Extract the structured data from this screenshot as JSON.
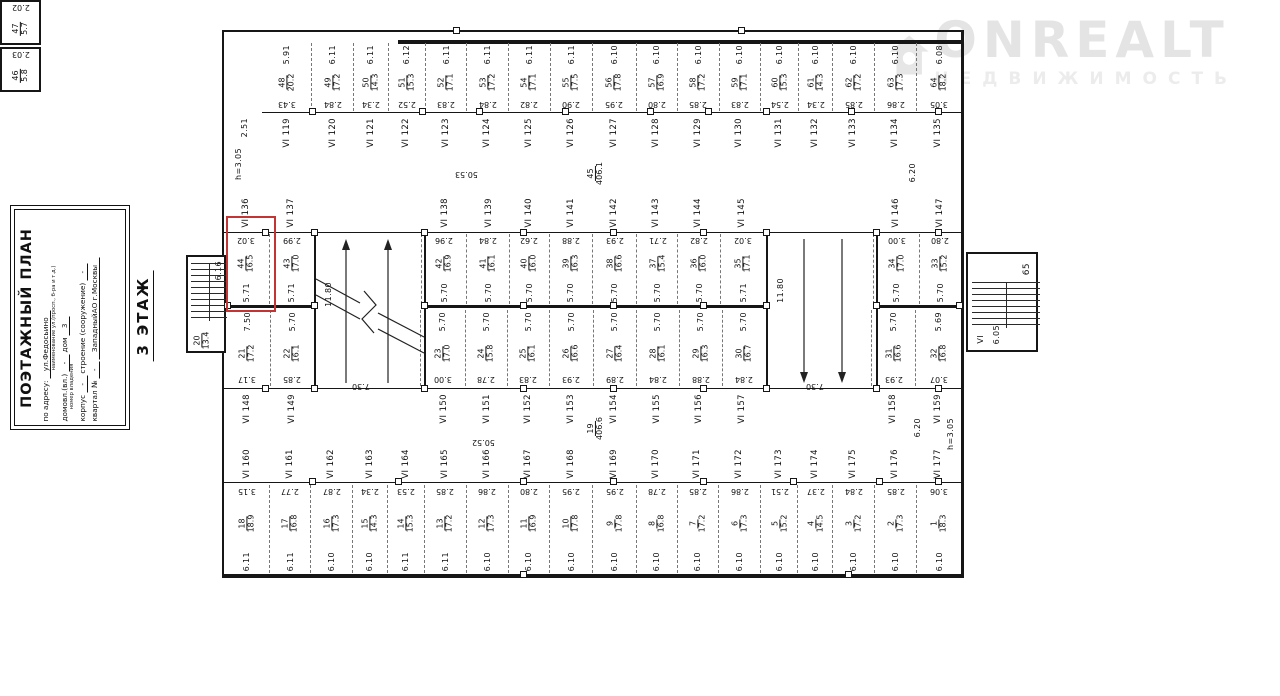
{
  "watermark": {
    "brand": "ONREALT",
    "subtitle": "НЕДВИЖИМОСТЬ"
  },
  "title_block": {
    "title": "ПОЭТАЖНЫЙ ПЛАН",
    "address_label": "по адресу:",
    "address_value": "ул.Федосьино",
    "address_caption": "наименование ул.(просп., б-ра и т.д.)",
    "ownership_label": "домовл.(вл.)",
    "ownership_value": "-",
    "ownership_caption": "номер владения",
    "house_label": "дом",
    "house_value": "3",
    "building_label": "корпус",
    "building_value": "-",
    "structure_label": "строение (сооружение)",
    "structure_value": "-",
    "block_label": "квартал №",
    "block_value": "-",
    "district_value": "ЗападныйАО г.Москвы"
  },
  "floor_label": "3 ЭТАЖ",
  "plan": {
    "left_dims": {
      "wall": "2.51",
      "note": "h=3.05"
    },
    "corner_rooms": [
      {
        "n": "47",
        "a": "5.7",
        "h": "2.02"
      },
      {
        "n": "46",
        "a": "5.8",
        "h": "2.03"
      }
    ],
    "top_units": [
      {
        "n": "48",
        "a": "20.2",
        "d": "5.91",
        "w": "3.43"
      },
      {
        "n": "49",
        "a": "17.2",
        "d": "6.11",
        "w": "2.84"
      },
      {
        "n": "50",
        "a": "14.3",
        "d": "6.11",
        "w": "2.34"
      },
      {
        "n": "51",
        "a": "15.3",
        "d": "6.12",
        "w": "2.52"
      },
      {
        "n": "52",
        "a": "17.1",
        "d": "6.11",
        "w": "2.83"
      },
      {
        "n": "53",
        "a": "17.2",
        "d": "6.11",
        "w": "2.84"
      },
      {
        "n": "54",
        "a": "17.1",
        "d": "6.11",
        "w": "2.82"
      },
      {
        "n": "55",
        "a": "17.5",
        "d": "6.11",
        "w": "2.90"
      },
      {
        "n": "56",
        "a": "17.8",
        "d": "6.10",
        "w": "2.95"
      },
      {
        "n": "57",
        "a": "16.9",
        "d": "6.10",
        "w": "2.80"
      },
      {
        "n": "58",
        "a": "17.2",
        "d": "6.10",
        "w": "2.85"
      },
      {
        "n": "59",
        "a": "17.1",
        "d": "6.10",
        "w": "2.83"
      },
      {
        "n": "60",
        "a": "15.3",
        "d": "6.10",
        "w": "2.54"
      },
      {
        "n": "61",
        "a": "14.3",
        "d": "6.10",
        "w": "2.34"
      },
      {
        "n": "62",
        "a": "17.2",
        "d": "6.10",
        "w": "2.85"
      },
      {
        "n": "63",
        "a": "17.3",
        "d": "6.10",
        "w": "2.86"
      },
      {
        "n": "64",
        "a": "18.2",
        "d": "6.08",
        "w": "3.05"
      }
    ],
    "vi_top": [
      "VI 119",
      "VI 120",
      "VI 121",
      "VI 122",
      "VI 123",
      "VI 124",
      "VI 125",
      "VI 126",
      "VI 127",
      "VI 128",
      "VI 129",
      "VI 130",
      "VI 131",
      "VI 132",
      "VI 133",
      "VI 134",
      "VI 135"
    ],
    "corridor_top": {
      "room": "45",
      "area": "406.1",
      "len": "50.53",
      "right_dim": "6.20"
    },
    "vi_upper": [
      "VI 136",
      "VI 137",
      "VI 138",
      "VI 139",
      "VI 140",
      "VI 141",
      "VI 142",
      "VI 143",
      "VI 144",
      "VI 145",
      "VI 146",
      "VI 147"
    ],
    "upper_mid_units": [
      {
        "n": "44",
        "a": "16.5",
        "w": "3.02",
        "d": "5.71"
      },
      {
        "n": "43",
        "a": "17.0",
        "w": "2.99",
        "d": "5.71"
      },
      {
        "ramp": "left",
        "w": "7.30"
      },
      {
        "n": "42",
        "a": "16.9",
        "w": "2.96",
        "d": "5.70"
      },
      {
        "n": "41",
        "a": "16.1",
        "w": "2.84",
        "d": "5.70"
      },
      {
        "n": "40",
        "a": "16.0",
        "w": "2.62",
        "d": "5.70"
      },
      {
        "n": "39",
        "a": "16.3",
        "w": "2.88",
        "d": "5.70"
      },
      {
        "n": "38",
        "a": "16.6",
        "w": "2.93",
        "d": "5.70"
      },
      {
        "n": "37",
        "a": "15.4",
        "w": "2.71",
        "d": "5.70"
      },
      {
        "n": "36",
        "a": "16.0",
        "w": "2.82",
        "d": "5.70"
      },
      {
        "n": "35",
        "a": "17.1",
        "w": "3.02",
        "d": "5.71"
      },
      {
        "ramp": "right",
        "w": "7.30"
      },
      {
        "n": "34",
        "a": "17.0",
        "w": "3.00",
        "d": "5.70"
      },
      {
        "n": "33",
        "a": "15.2",
        "w": "2.80",
        "d": "5.70"
      }
    ],
    "lower_mid_units": [
      {
        "n": "21",
        "a": "17.2",
        "d": "7.50",
        "w": "3.17"
      },
      {
        "n": "22",
        "a": "16.1",
        "d": "5.70",
        "w": "2.85"
      },
      {
        "ramp": "left",
        "w": "7.30"
      },
      {
        "n": "23",
        "a": "17.0",
        "d": "5.70",
        "w": "3.00"
      },
      {
        "n": "24",
        "a": "15.8",
        "d": "5.70",
        "w": "2.78"
      },
      {
        "n": "25",
        "a": "16.1",
        "d": "5.70",
        "w": "2.83"
      },
      {
        "n": "26",
        "a": "16.6",
        "d": "5.70",
        "w": "2.93"
      },
      {
        "n": "27",
        "a": "16.4",
        "d": "5.70",
        "w": "2.89"
      },
      {
        "n": "28",
        "a": "16.1",
        "d": "5.70",
        "w": "2.84"
      },
      {
        "n": "29",
        "a": "16.3",
        "d": "5.70",
        "w": "2.88"
      },
      {
        "n": "30",
        "a": "16.7",
        "d": "5.70",
        "w": "2.84"
      },
      {
        "ramp": "right",
        "w": "7.30"
      },
      {
        "n": "31",
        "a": "16.6",
        "d": "5.70",
        "w": "2.93"
      },
      {
        "n": "32",
        "a": "16.8",
        "d": "5.69",
        "w": "3.07"
      }
    ],
    "vi_lower": [
      "VI 148",
      "VI 149",
      "VI 150",
      "VI 151",
      "VI 152",
      "VI 153",
      "VI 154",
      "VI 155",
      "VI 156",
      "VI 157",
      "VI 158",
      "VI 159"
    ],
    "corridor_bottom": {
      "room": "19",
      "area": "406.6",
      "len": "50.52",
      "right_dim": "6.20",
      "note": "h=3.05"
    },
    "vi_bottom": [
      "VI 160",
      "VI 161",
      "VI 162",
      "VI 163",
      "VI 164",
      "VI 165",
      "VI 166",
      "VI 167",
      "VI 168",
      "VI 169",
      "VI 170",
      "VI 171",
      "VI 172",
      "VI 173",
      "VI 174",
      "VI 175",
      "VI 176",
      "VI 177"
    ],
    "bottom_units": [
      {
        "n": "18",
        "a": "18.9",
        "w": "3.15",
        "d": "6.11"
      },
      {
        "n": "17",
        "a": "16.8",
        "w": "2.77",
        "d": "6.11"
      },
      {
        "n": "16",
        "a": "17.3",
        "w": "2.87",
        "d": "6.10"
      },
      {
        "n": "15",
        "a": "14.3",
        "w": "2.34",
        "d": "6.10"
      },
      {
        "n": "14",
        "a": "15.3",
        "w": "2.53",
        "d": "6.11"
      },
      {
        "n": "13",
        "a": "17.2",
        "w": "2.85",
        "d": "6.11"
      },
      {
        "n": "12",
        "a": "17.3",
        "w": "2.86",
        "d": "6.10"
      },
      {
        "n": "11",
        "a": "16.9",
        "w": "2.80",
        "d": "6.10"
      },
      {
        "n": "10",
        "a": "17.8",
        "w": "2.95",
        "d": "6.10"
      },
      {
        "n": "9",
        "a": "17.8",
        "w": "2.95",
        "d": "6.10"
      },
      {
        "n": "8",
        "a": "16.8",
        "w": "2.78",
        "d": "6.10"
      },
      {
        "n": "7",
        "a": "17.2",
        "w": "2.85",
        "d": "6.10"
      },
      {
        "n": "6",
        "a": "17.3",
        "w": "2.86",
        "d": "6.10"
      },
      {
        "n": "5",
        "a": "15.2",
        "w": "2.51",
        "d": "6.10"
      },
      {
        "n": "4",
        "a": "14.5",
        "w": "2.37",
        "d": "6.10"
      },
      {
        "n": "3",
        "a": "17.2",
        "w": "2.84",
        "d": "6.10"
      },
      {
        "n": "2",
        "a": "17.3",
        "w": "2.85",
        "d": "6.10"
      },
      {
        "n": "1",
        "a": "18.3",
        "w": "3.06",
        "d": "6.10"
      }
    ],
    "ramp_left": {
      "len": "11.80",
      "wid": "7.30"
    },
    "ramp_right": {
      "len": "11.80",
      "wid": "7.30"
    },
    "stairs_left": {
      "room": "20",
      "area": "13.4",
      "dim": "6.16"
    },
    "stairs_right": {
      "room": "65",
      "corr": "VI",
      "dim": "6.05"
    }
  }
}
